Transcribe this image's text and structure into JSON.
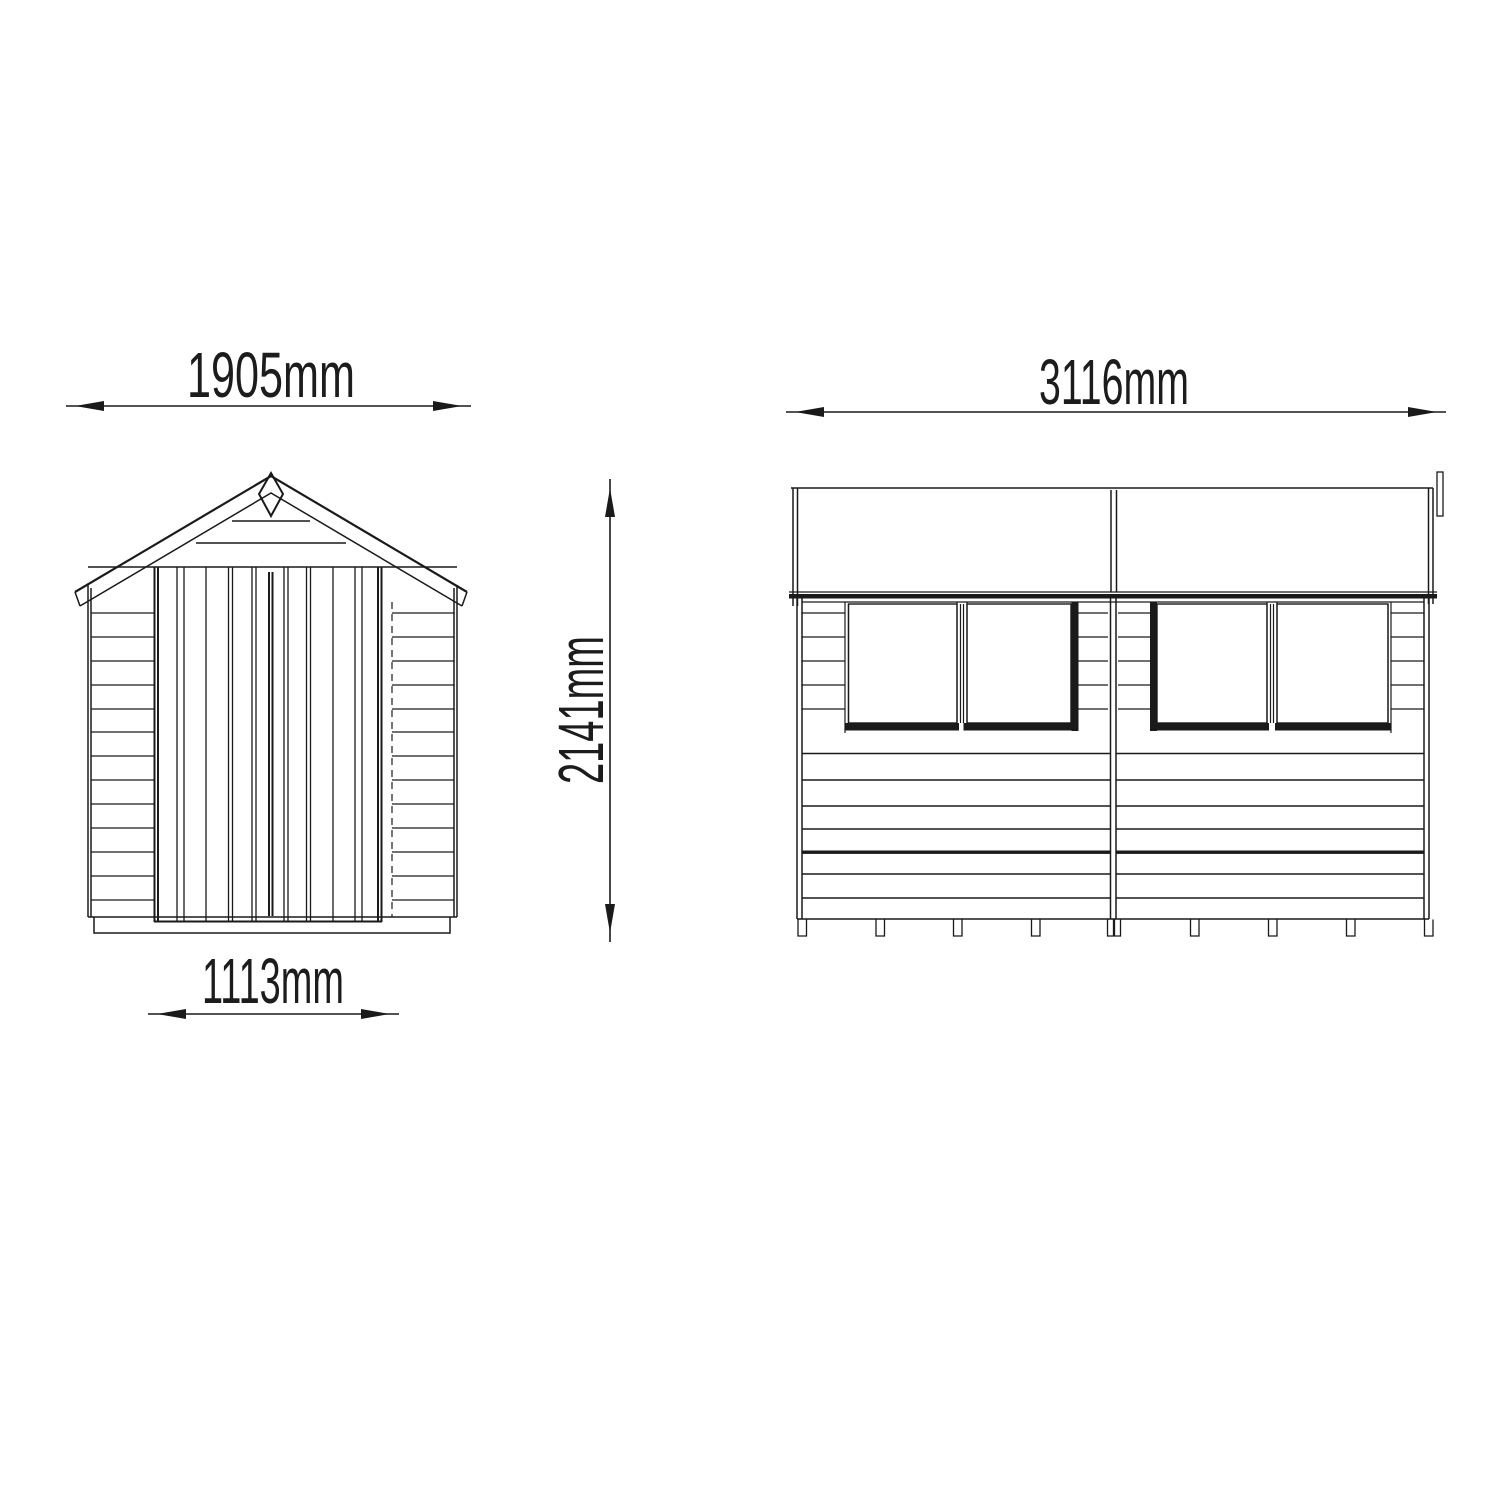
{
  "drawing": {
    "front_view": {
      "width_label": "1905mm",
      "door_width_label": "1113mm",
      "height_label": "2141mm"
    },
    "side_view": {
      "length_label": "3116mm"
    }
  },
  "colors": {
    "line": "#1a1a1a",
    "background": "#ffffff"
  }
}
